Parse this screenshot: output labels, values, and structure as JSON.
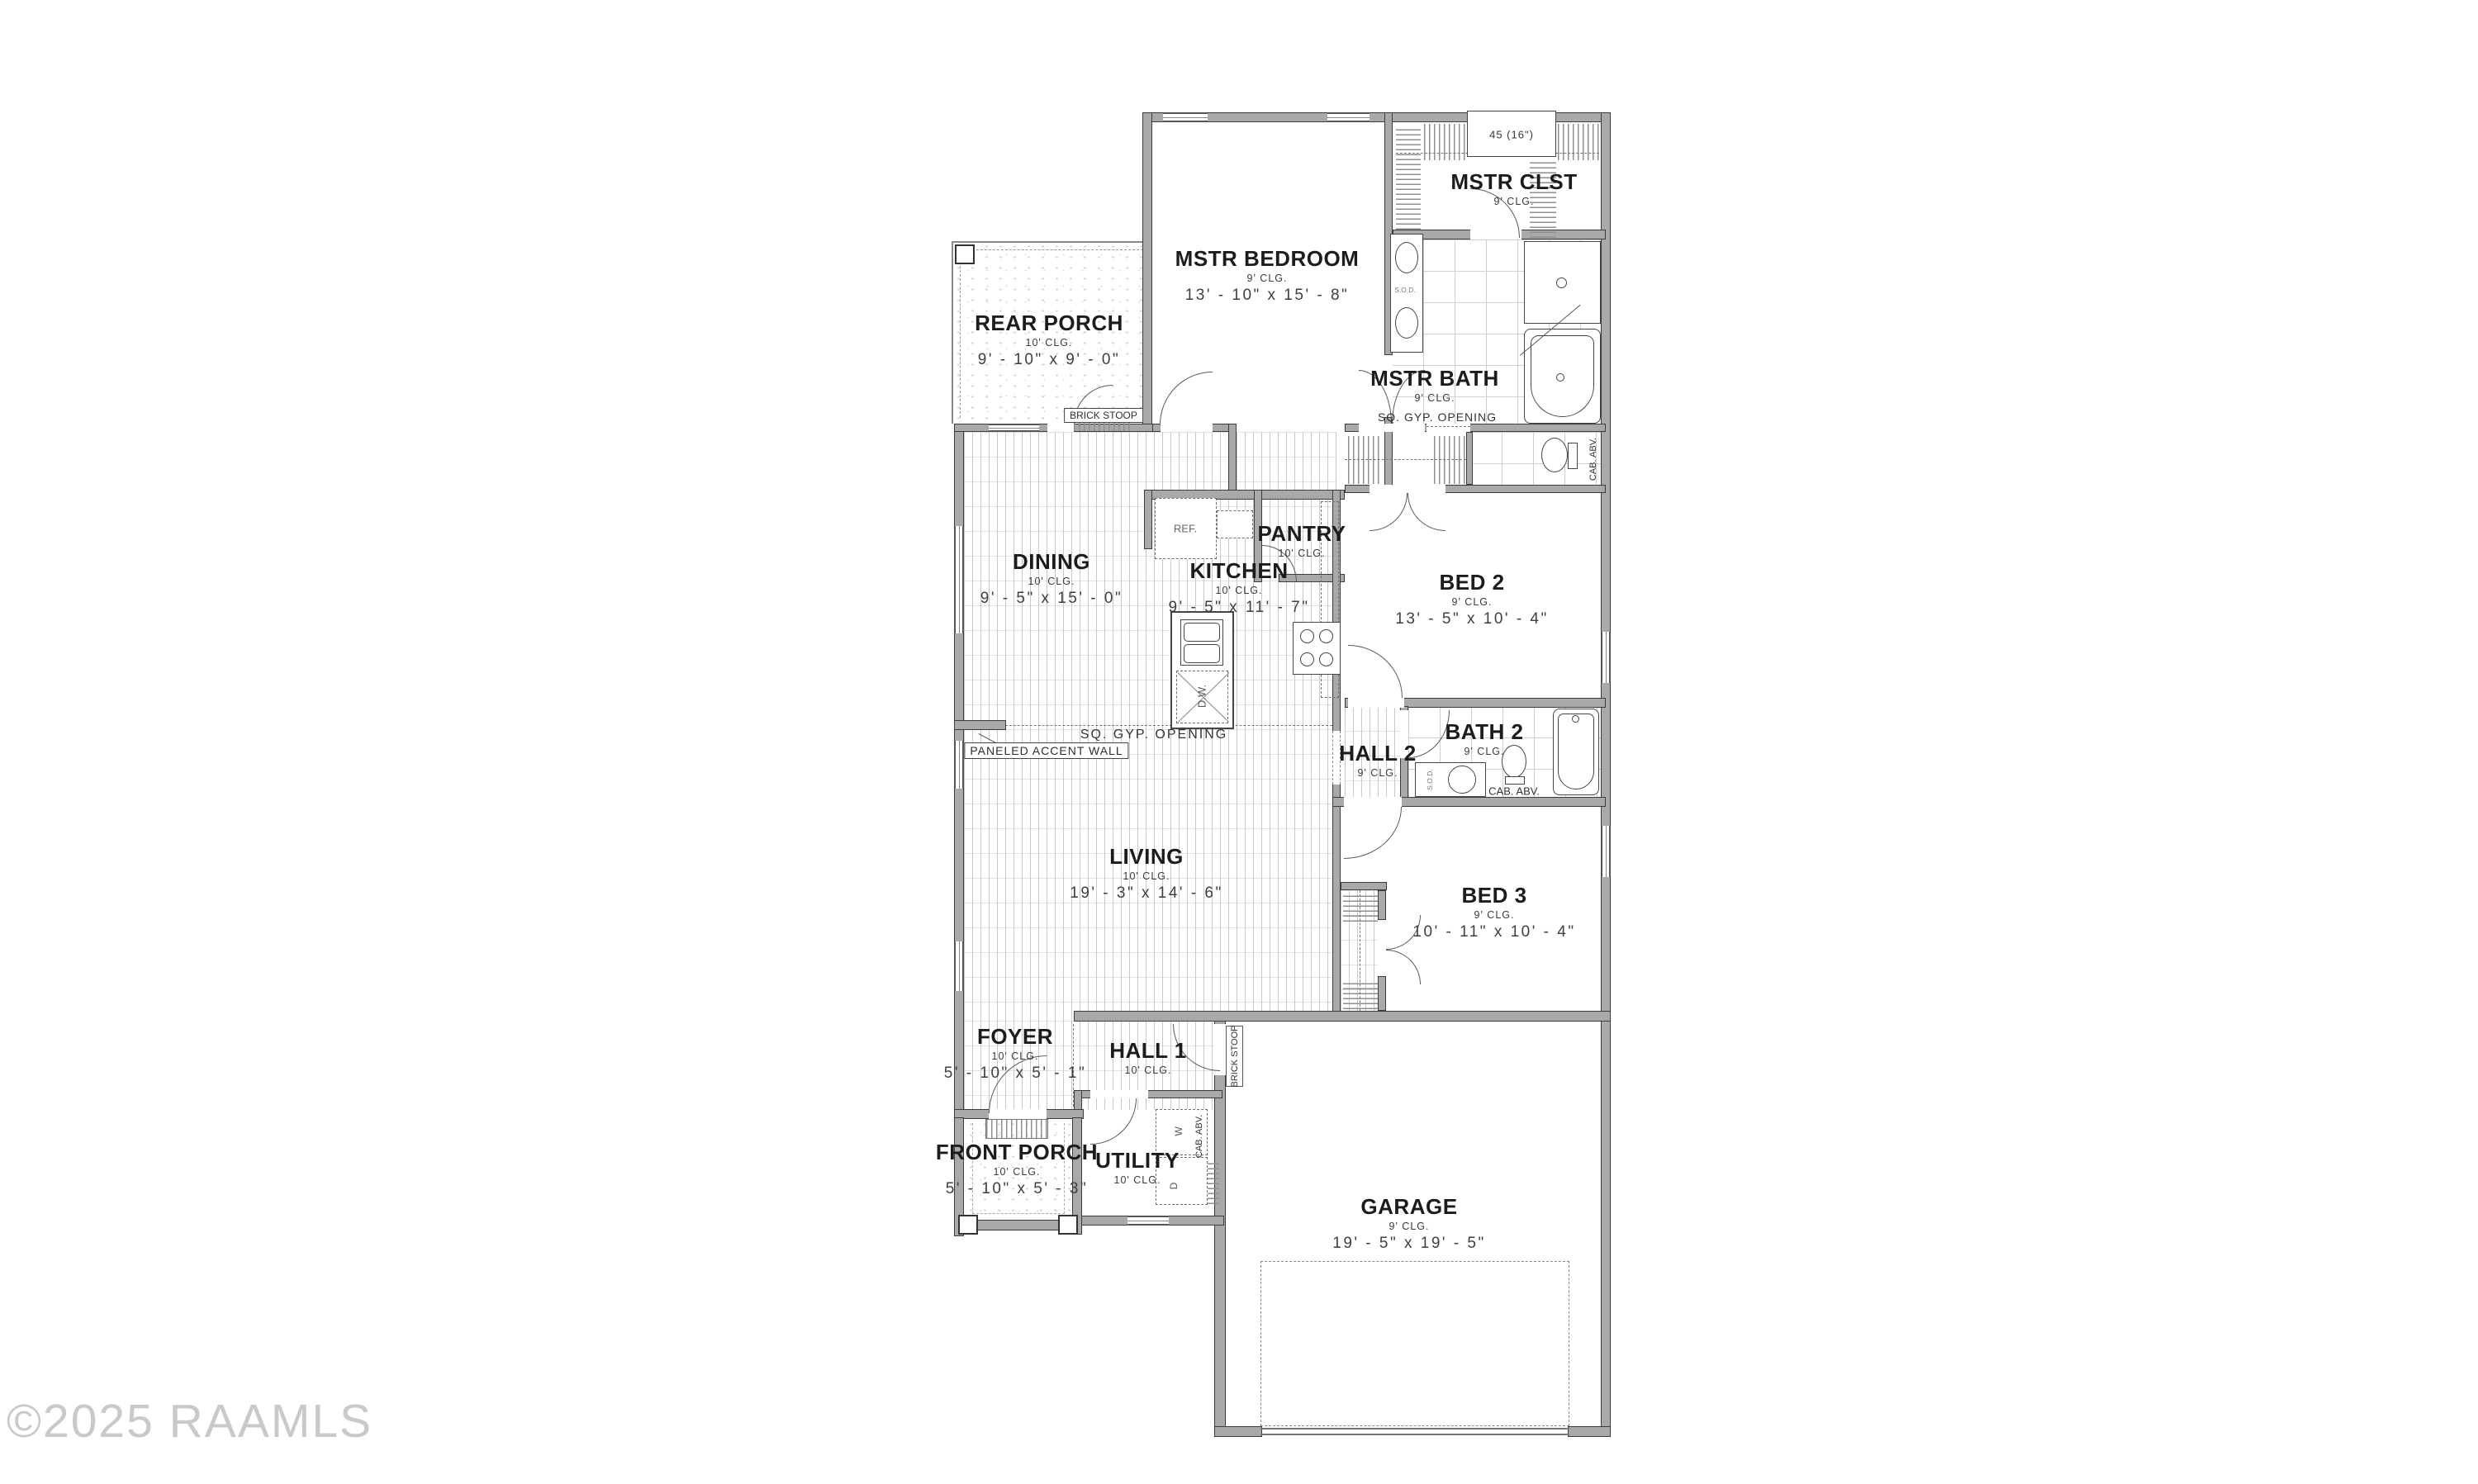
{
  "watermark": "©2025 RAAMLS",
  "rooms": {
    "rear_porch": {
      "name": "REAR PORCH",
      "ceiling": "10' CLG.",
      "dims": "9' - 10\" x 9' - 0\""
    },
    "mstr_bedroom": {
      "name": "MSTR BEDROOM",
      "ceiling": "9' CLG.",
      "dims": "13' - 10\" x 15' - 8\""
    },
    "mstr_clst": {
      "name": "MSTR CLST",
      "ceiling": "9' CLG."
    },
    "mstr_bath": {
      "name": "MSTR BATH",
      "ceiling": "9' CLG."
    },
    "dining": {
      "name": "DINING",
      "ceiling": "10' CLG.",
      "dims": "9' - 5\" x 15' - 0\""
    },
    "kitchen": {
      "name": "KITCHEN",
      "ceiling": "10' CLG.",
      "dims": "9' - 5\" x 11' - 7\""
    },
    "pantry": {
      "name": "PANTRY",
      "ceiling": "10' CLG."
    },
    "bed2": {
      "name": "BED 2",
      "ceiling": "9' CLG.",
      "dims": "13' - 5\" x 10' - 4\""
    },
    "hall2": {
      "name": "HALL 2",
      "ceiling": "9' CLG."
    },
    "bath2": {
      "name": "BATH 2",
      "ceiling": "9' CLG."
    },
    "bed3": {
      "name": "BED 3",
      "ceiling": "9' CLG.",
      "dims": "10' - 11\" x 10' - 4\""
    },
    "living": {
      "name": "LIVING",
      "ceiling": "10' CLG.",
      "dims": "19' - 3\" x 14' - 6\""
    },
    "foyer": {
      "name": "FOYER",
      "ceiling": "10' CLG.",
      "dims": "5' - 10\" x 5' - 1\""
    },
    "hall1": {
      "name": "HALL 1",
      "ceiling": "10' CLG."
    },
    "front_porch": {
      "name": "FRONT PORCH",
      "ceiling": "10' CLG.",
      "dims": "5' - 10\" x 5' - 3\""
    },
    "utility": {
      "name": "UTILITY",
      "ceiling": "10' CLG."
    },
    "garage": {
      "name": "GARAGE",
      "ceiling": "9' CLG.",
      "dims": "19' - 5\" x 19' - 5\""
    }
  },
  "annotations": {
    "closet_shelf_note": "45 (16\")",
    "sq_gyp_opening": "SQ. GYP. OPENING",
    "paneled_accent_wall": "PANELED ACCENT WALL",
    "brick_stoop": "BRICK STOOP",
    "cab_abv": "CAB. ABV.",
    "sod": "S.O.D.",
    "ref": "REF.",
    "dw": "D.W.",
    "washer": "W",
    "dryer": "D"
  },
  "colors": {
    "wall": "#a9a9a9",
    "wall_edge": "#3c3c3c",
    "line": "#555555",
    "text": "#1c1c1c",
    "dim_text": "#3f3f3f",
    "watermark": "#c9c9c9"
  }
}
